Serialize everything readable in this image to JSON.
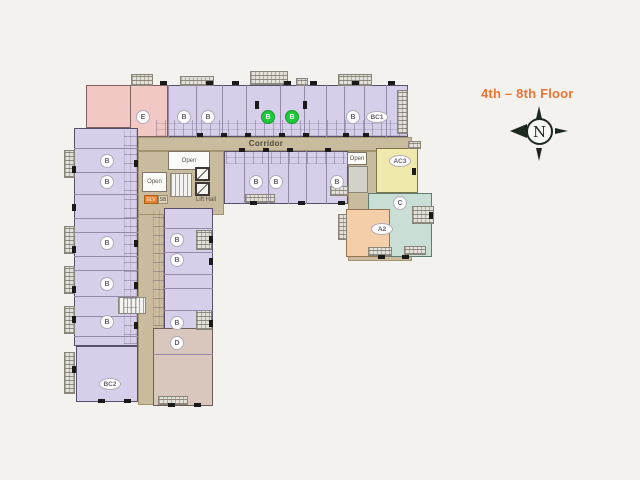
{
  "labels": {
    "title": "4th – 8th Floor",
    "compass_n": "N",
    "corridor": "Corridor",
    "open_top": "Open",
    "open_left": "Open",
    "open_right": "Open",
    "lift_hall": "Lift Hall",
    "elv": "ELV",
    "sb": "SB"
  },
  "colors": {
    "background": "#f3f2ef",
    "unit_lavender": "#d7cee9",
    "unit_pink": "#f2c8c4",
    "unit_yellow": "#efe9ae",
    "unit_teal": "#c9dfd5",
    "unit_orange": "#f4cda9",
    "unit_mauve": "#d9c6bd",
    "corridor_tan": "#c9bc9e",
    "wall_dark": "#4b4455",
    "available_green": "#1fc93c",
    "title_orange": "#ee7433"
  },
  "plan": {
    "blocks": [
      {
        "n": "wing-top-row",
        "f": "lav",
        "x": 152,
        "y": 85,
        "w": 256,
        "h": 52
      },
      {
        "n": "pink-corner-unit",
        "f": "pink",
        "x": 86,
        "y": 85,
        "w": 68,
        "h": 43
      },
      {
        "n": "unit-E",
        "f": "pink",
        "x": 130,
        "y": 85,
        "w": 38,
        "h": 52
      },
      {
        "n": "wing-left-column",
        "f": "lav",
        "x": 74,
        "y": 128,
        "w": 64,
        "h": 218
      },
      {
        "n": "unit-BC2",
        "f": "lav",
        "x": 76,
        "y": 346,
        "w": 62,
        "h": 56
      },
      {
        "n": "corridor-horizontal",
        "f": "tan",
        "x": 138,
        "y": 137,
        "w": 274,
        "h": 14
      },
      {
        "n": "corridor-vertical",
        "f": "tan",
        "x": 138,
        "y": 151,
        "w": 26,
        "h": 254
      },
      {
        "n": "core-hall",
        "f": "tan",
        "x": 138,
        "y": 151,
        "w": 86,
        "h": 64
      },
      {
        "n": "right-section-base",
        "f": "tan",
        "x": 348,
        "y": 151,
        "w": 64,
        "h": 110
      },
      {
        "n": "wing-inner-column",
        "f": "lav",
        "x": 164,
        "y": 208,
        "w": 49,
        "h": 122
      },
      {
        "n": "unit-D",
        "f": "mauve",
        "x": 153,
        "y": 328,
        "w": 60,
        "h": 78
      },
      {
        "n": "wing-lower-row",
        "f": "lav",
        "x": 224,
        "y": 151,
        "w": 124,
        "h": 53
      },
      {
        "n": "unit-AC3",
        "f": "yellow",
        "x": 376,
        "y": 148,
        "w": 42,
        "h": 45
      },
      {
        "n": "unit-C",
        "f": "teal",
        "x": 368,
        "y": 193,
        "w": 64,
        "h": 64
      },
      {
        "n": "unit-A2",
        "f": "orange",
        "x": 346,
        "y": 209,
        "w": 44,
        "h": 48
      },
      {
        "n": "service-shaft",
        "f": "gray",
        "x": 348,
        "y": 166,
        "w": 20,
        "h": 27
      },
      {
        "n": "open-area-top",
        "f": "white",
        "x": 168,
        "y": 151,
        "w": 42,
        "h": 19,
        "label": "open_top"
      },
      {
        "n": "open-area-left",
        "f": "white",
        "x": 142,
        "y": 172,
        "w": 25,
        "h": 20,
        "label": "open_left"
      },
      {
        "n": "open-area-right",
        "f": "white",
        "x": 347,
        "y": 152,
        "w": 20,
        "h": 13,
        "label": "open_right"
      },
      {
        "n": "stairs-core",
        "f": "stairs",
        "x": 170,
        "y": 173,
        "w": 22,
        "h": 24
      },
      {
        "n": "lift-shaft-1",
        "f": "lift",
        "x": 195,
        "y": 167,
        "w": 15,
        "h": 14
      },
      {
        "n": "lift-shaft-2",
        "f": "lift",
        "x": 195,
        "y": 182,
        "w": 15,
        "h": 14
      },
      {
        "n": "stairs-left-wing",
        "f": "stairs",
        "x": 118,
        "y": 297,
        "w": 28,
        "h": 17
      },
      {
        "n": "elv-box",
        "f": "elv",
        "x": 144,
        "y": 195,
        "w": 14,
        "h": 9,
        "label": "elv"
      },
      {
        "n": "sb-box",
        "f": "sbx",
        "x": 158,
        "y": 195,
        "w": 10,
        "h": 9,
        "label": "sb"
      }
    ],
    "textures": [
      {
        "n": "bath-detail-top-row",
        "kind": "v",
        "x": 156,
        "y": 120,
        "w": 250,
        "h": 16
      },
      {
        "n": "bath-detail-lower-row",
        "kind": "v",
        "x": 226,
        "y": 152,
        "w": 120,
        "h": 12
      },
      {
        "n": "bath-detail-left-column",
        "kind": "h",
        "x": 124,
        "y": 130,
        "w": 13,
        "h": 214
      },
      {
        "n": "bath-detail-inner-column",
        "kind": "h",
        "x": 153,
        "y": 210,
        "w": 11,
        "h": 116
      }
    ],
    "balconies": [
      [
        131,
        74,
        22,
        12
      ],
      [
        180,
        76,
        34,
        10
      ],
      [
        250,
        71,
        38,
        14
      ],
      [
        296,
        78,
        12,
        8
      ],
      [
        338,
        74,
        34,
        12
      ],
      [
        397,
        90,
        11,
        44
      ],
      [
        64,
        150,
        11,
        28
      ],
      [
        64,
        226,
        11,
        28
      ],
      [
        64,
        266,
        11,
        28
      ],
      [
        64,
        306,
        11,
        28
      ],
      [
        64,
        352,
        11,
        42
      ],
      [
        245,
        194,
        30,
        9
      ],
      [
        330,
        186,
        18,
        10
      ],
      [
        196,
        230,
        16,
        20
      ],
      [
        196,
        310,
        16,
        20
      ],
      [
        412,
        206,
        22,
        18
      ],
      [
        368,
        247,
        24,
        9
      ],
      [
        404,
        246,
        22,
        9
      ],
      [
        338,
        214,
        9,
        26
      ],
      [
        408,
        141,
        13,
        8
      ],
      [
        158,
        396,
        30,
        9
      ]
    ],
    "dividers": {
      "v": [
        [
          168,
          85,
          52
        ],
        [
          196,
          85,
          52
        ],
        [
          222,
          85,
          52
        ],
        [
          246,
          85,
          52
        ],
        [
          280,
          85,
          52
        ],
        [
          304,
          85,
          52
        ],
        [
          326,
          85,
          52
        ],
        [
          344,
          85,
          52
        ],
        [
          364,
          85,
          52
        ],
        [
          386,
          85,
          52
        ],
        [
          244,
          151,
          53
        ],
        [
          268,
          151,
          53
        ],
        [
          288,
          151,
          53
        ],
        [
          306,
          151,
          53
        ],
        [
          326,
          151,
          53
        ]
      ],
      "h": [
        [
          74,
          148,
          64
        ],
        [
          74,
          172,
          64
        ],
        [
          74,
          194,
          64
        ],
        [
          74,
          218,
          64
        ],
        [
          74,
          232,
          64
        ],
        [
          74,
          256,
          64
        ],
        [
          74,
          270,
          64
        ],
        [
          74,
          296,
          64
        ],
        [
          74,
          316,
          64
        ],
        [
          74,
          336,
          64
        ],
        [
          164,
          228,
          49
        ],
        [
          164,
          252,
          49
        ],
        [
          164,
          274,
          49
        ],
        [
          164,
          288,
          49
        ],
        [
          164,
          310,
          49
        ],
        [
          153,
          354,
          60
        ]
      ]
    },
    "marks": [
      [
        160,
        81,
        7,
        4
      ],
      [
        206,
        81,
        7,
        4
      ],
      [
        232,
        81,
        7,
        4
      ],
      [
        284,
        81,
        7,
        4
      ],
      [
        310,
        81,
        7,
        4
      ],
      [
        352,
        81,
        7,
        4
      ],
      [
        388,
        81,
        7,
        4
      ],
      [
        255,
        101,
        4,
        8
      ],
      [
        303,
        101,
        4,
        8
      ],
      [
        197,
        133,
        6,
        4
      ],
      [
        221,
        133,
        6,
        4
      ],
      [
        245,
        133,
        6,
        4
      ],
      [
        279,
        133,
        6,
        4
      ],
      [
        303,
        133,
        6,
        4
      ],
      [
        343,
        133,
        6,
        4
      ],
      [
        363,
        133,
        6,
        4
      ],
      [
        239,
        148,
        6,
        4
      ],
      [
        263,
        148,
        6,
        4
      ],
      [
        287,
        148,
        6,
        4
      ],
      [
        325,
        148,
        6,
        4
      ],
      [
        72,
        166,
        4,
        7
      ],
      [
        72,
        204,
        4,
        7
      ],
      [
        72,
        246,
        4,
        7
      ],
      [
        72,
        286,
        4,
        7
      ],
      [
        72,
        316,
        4,
        7
      ],
      [
        72,
        366,
        4,
        7
      ],
      [
        134,
        160,
        4,
        7
      ],
      [
        134,
        240,
        4,
        7
      ],
      [
        134,
        282,
        4,
        7
      ],
      [
        134,
        322,
        4,
        7
      ],
      [
        209,
        236,
        4,
        7
      ],
      [
        209,
        258,
        4,
        7
      ],
      [
        209,
        320,
        4,
        7
      ],
      [
        98,
        399,
        7,
        4
      ],
      [
        124,
        399,
        7,
        4
      ],
      [
        168,
        403,
        7,
        4
      ],
      [
        194,
        403,
        7,
        4
      ],
      [
        250,
        201,
        7,
        4
      ],
      [
        298,
        201,
        7,
        4
      ],
      [
        338,
        201,
        7,
        4
      ],
      [
        378,
        255,
        7,
        4
      ],
      [
        402,
        255,
        7,
        4
      ],
      [
        429,
        212,
        4,
        7
      ],
      [
        412,
        168,
        4,
        7
      ]
    ],
    "unit_labels": [
      {
        "t": "E",
        "x": 143,
        "y": 117,
        "s": "c"
      },
      {
        "t": "B",
        "x": 184,
        "y": 117,
        "s": "c"
      },
      {
        "t": "B",
        "x": 208,
        "y": 117,
        "s": "c"
      },
      {
        "t": "B",
        "x": 268,
        "y": 117,
        "s": "g"
      },
      {
        "t": "B",
        "x": 292,
        "y": 117,
        "s": "g"
      },
      {
        "t": "B",
        "x": 353,
        "y": 117,
        "s": "c"
      },
      {
        "t": "BC1",
        "x": 377,
        "y": 117,
        "s": "e"
      },
      {
        "t": "B",
        "x": 256,
        "y": 182,
        "s": "c"
      },
      {
        "t": "B",
        "x": 276,
        "y": 182,
        "s": "c"
      },
      {
        "t": "B",
        "x": 337,
        "y": 182,
        "s": "c"
      },
      {
        "t": "B",
        "x": 107,
        "y": 161,
        "s": "c"
      },
      {
        "t": "B",
        "x": 107,
        "y": 182,
        "s": "c"
      },
      {
        "t": "B",
        "x": 107,
        "y": 243,
        "s": "c"
      },
      {
        "t": "B",
        "x": 107,
        "y": 284,
        "s": "c"
      },
      {
        "t": "B",
        "x": 107,
        "y": 322,
        "s": "c"
      },
      {
        "t": "BC2",
        "x": 110,
        "y": 384,
        "s": "e"
      },
      {
        "t": "B",
        "x": 177,
        "y": 240,
        "s": "c"
      },
      {
        "t": "B",
        "x": 177,
        "y": 260,
        "s": "c"
      },
      {
        "t": "B",
        "x": 177,
        "y": 323,
        "s": "c"
      },
      {
        "t": "D",
        "x": 177,
        "y": 343,
        "s": "c"
      },
      {
        "t": "AC3",
        "x": 400,
        "y": 161,
        "s": "e"
      },
      {
        "t": "C",
        "x": 400,
        "y": 203,
        "s": "c"
      },
      {
        "t": "A2",
        "x": 382,
        "y": 229,
        "s": "e"
      }
    ]
  }
}
